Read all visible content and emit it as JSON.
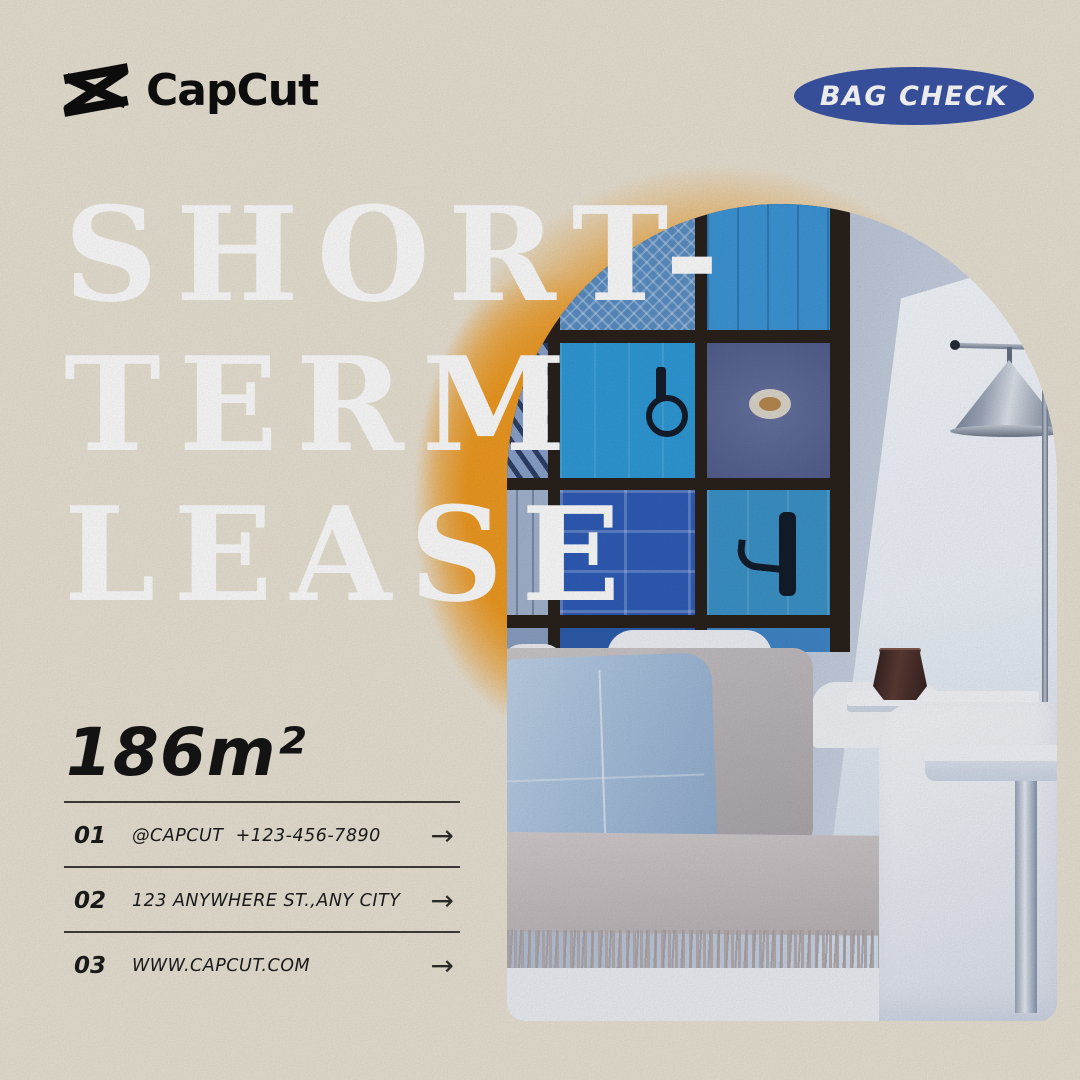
{
  "brand": {
    "name": "CapCut"
  },
  "badge": {
    "label": "BAG CHECK"
  },
  "headline": {
    "line1": "SHORT-",
    "line2": "TERM",
    "line3": "LEASE"
  },
  "area": {
    "value": "186m²"
  },
  "contacts": {
    "items": [
      {
        "num": "01",
        "text": "@CAPCUT  +123-456-7890",
        "arrow": "→"
      },
      {
        "num": "02",
        "text": "123 ANYWHERE ST.,ANY CITY",
        "arrow": "→"
      },
      {
        "num": "03",
        "text": "WWW.CAPCUT.COM",
        "arrow": "→"
      }
    ]
  },
  "colors": {
    "background": "#eae3d4",
    "glow_orange": "#ef9a21",
    "badge_blue": "#3a54a5",
    "headline_white": "#ffffff",
    "text_black": "#1b1b1b"
  },
  "icons": {
    "logo_icon": "capcut-bowtie-icon",
    "arrow_icon": "right-arrow"
  }
}
